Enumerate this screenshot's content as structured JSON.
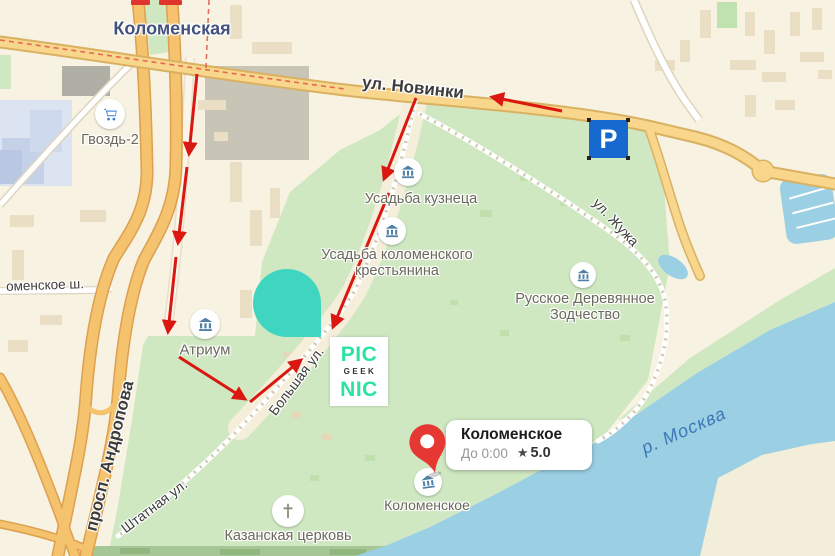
{
  "map": {
    "metro_label": "Коломенская",
    "streets": {
      "novinki": "ул. Новинки",
      "andropova": "просп. Андропова",
      "bolshaya": "Большая ул.",
      "shtatnaya": "Штатная ул.",
      "zhuzha": "ул. Жужа",
      "kolomenskoe_highway": "оменское ш."
    },
    "river_label": "р. Москва",
    "pois": [
      {
        "label": "Гвоздь-2",
        "icon": "shopping-cart-icon"
      },
      {
        "label": "Усадьба кузнеца",
        "icon": "museum-icon"
      },
      {
        "label": "Усадьба коломенского крестьянина",
        "icon": "museum-icon"
      },
      {
        "label": "Русское Деревянное Зодчество",
        "icon": "museum-icon"
      },
      {
        "label": "Атриум",
        "icon": "museum-icon"
      },
      {
        "label": "Казанская церковь",
        "icon": "church-cross-icon"
      },
      {
        "label": "Коломенское",
        "icon": "museum-icon"
      }
    ],
    "parking_label": "P"
  },
  "callout": {
    "title": "Коломенское",
    "hours": "До 0:00",
    "star": "★",
    "rating": "5.0"
  },
  "logo": {
    "top": "PIC",
    "middle": "GEEK",
    "bottom": "NIC"
  },
  "colors": {
    "park_green": "#cfe8c2",
    "water_blue": "#9bcfe3",
    "arrow_red": "#da1710",
    "pin_red": "#e63832",
    "teal_blob": "#3fd5c0",
    "logo_green": "#2be3a0",
    "parking_blue": "#1569cf"
  }
}
